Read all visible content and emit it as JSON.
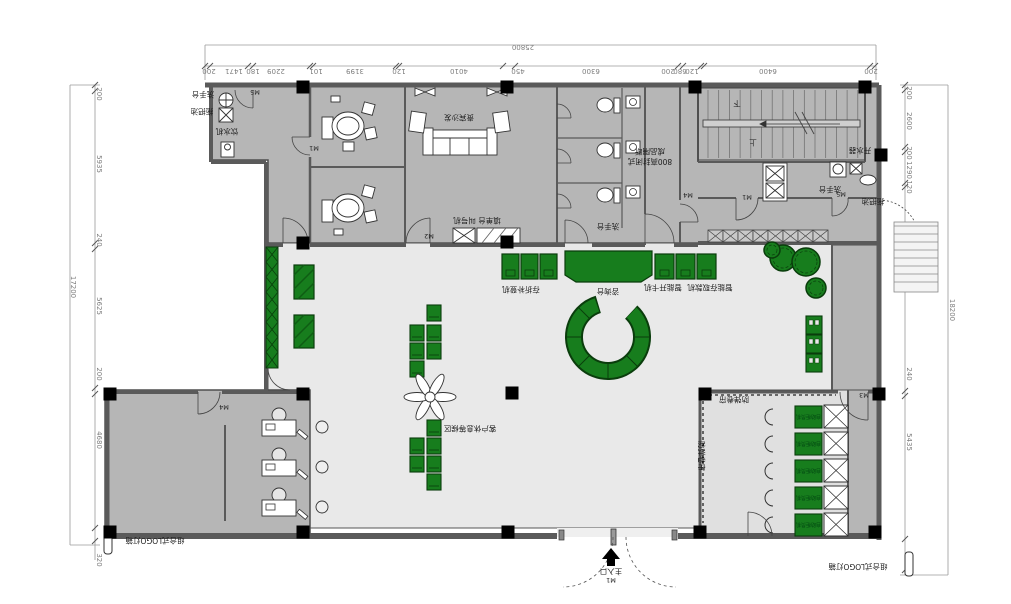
{
  "colors": {
    "wall_fill": "#b6b6b6",
    "wall_line": "#4f4f4f",
    "floor": "#e9e9e9",
    "floor2": "#e0e0e0",
    "green": "#177d1d",
    "green_dark": "#0a3d0c",
    "column": "#000000",
    "dim": "#7d7d7d"
  },
  "labels": {
    "wash_basin_tl": "洗手台",
    "mop_pool_tl": "拖把池",
    "water_dispenser": "饮水机",
    "sofa_room": "贵宾沙发",
    "form_desk": "填单台 叫号机",
    "wc_partition_line1": "800高封闭式",
    "wc_partition_line2": "成品隔断",
    "wc_wash": "洗手台",
    "stair_up": "上",
    "stair_down": "下",
    "boiler": "开水器",
    "kitchen_wash": "洗手台",
    "kitchen_mop": "拖把池",
    "passbook_machine": "存折补登机",
    "counter": "咨询台",
    "smart_card_machine": "智能开卡机",
    "smart_cash_machine": "智能存取款机",
    "waiting_area": "客户休息等候区",
    "shutter_top": "防弹卷帘",
    "shutter_left": "防弹卷帘",
    "atm": "自助柜员机",
    "entrance": "主入口",
    "logo_left": "组合式LOGO灯箱",
    "logo_right": "组合式LOGO灯箱"
  },
  "door_tags": [
    {
      "t": "M5",
      "x": 255,
      "y": 96
    },
    {
      "t": "M1",
      "x": 314,
      "y": 152
    },
    {
      "t": "M2",
      "x": 429,
      "y": 240
    },
    {
      "t": "M4",
      "x": 688,
      "y": 199
    },
    {
      "t": "M1",
      "x": 747,
      "y": 201
    },
    {
      "t": "M5",
      "x": 841,
      "y": 198
    },
    {
      "t": "M4",
      "x": 224,
      "y": 411
    },
    {
      "t": "M3",
      "x": 864,
      "y": 399
    },
    {
      "t": "M1",
      "x": 611,
      "y": 584
    }
  ],
  "dims": {
    "top": {
      "total": "25800",
      "total_pos": [
        523,
        49
      ],
      "line_total_y": 45,
      "line_seg_y": 66,
      "x1": 205,
      "x2": 876,
      "segments": [
        {
          "t": "200",
          "x": 209
        },
        {
          "t": "1471",
          "x": 234
        },
        {
          "t": "180",
          "x": 253
        },
        {
          "t": "2209",
          "x": 276
        },
        {
          "t": "101",
          "x": 316
        },
        {
          "t": "3199",
          "x": 355
        },
        {
          "t": "120",
          "x": 399
        },
        {
          "t": "4010",
          "x": 459
        },
        {
          "t": "450",
          "x": 518
        },
        {
          "t": "6300",
          "x": 591
        },
        {
          "t": "200",
          "x": 668
        },
        {
          "t": "680",
          "x": 680
        },
        {
          "t": "120",
          "x": 692
        },
        {
          "t": "6400",
          "x": 768
        },
        {
          "t": "200",
          "x": 871
        }
      ],
      "ticks": [
        205,
        210,
        248,
        253,
        310,
        313,
        396,
        399,
        503,
        515,
        678,
        683,
        701,
        704,
        870,
        875
      ]
    },
    "left": {
      "total": "17200",
      "total_pos": [
        71,
        287
      ],
      "line_total_x": 70,
      "line_seg_x": 95,
      "y1": 85,
      "y2": 560,
      "segments": [
        {
          "t": "200",
          "y": 94
        },
        {
          "t": "5935",
          "y": 164
        },
        {
          "t": "240",
          "y": 240
        },
        {
          "t": "5625",
          "y": 306
        },
        {
          "t": "200",
          "y": 374
        },
        {
          "t": "4680",
          "y": 440
        },
        {
          "t": "320",
          "y": 560
        }
      ],
      "ticks": [
        85,
        91,
        243,
        249,
        388,
        394,
        528,
        541
      ]
    },
    "right": {
      "total": "18200",
      "total_pos": [
        950,
        310
      ],
      "line_total_x": 948,
      "line_seg_x": 905,
      "y1": 85,
      "y2": 575,
      "segments": [
        {
          "t": "200",
          "y": 93
        },
        {
          "t": "2600",
          "y": 121
        },
        {
          "t": "200",
          "y": 153
        },
        {
          "t": "1290",
          "y": 170
        },
        {
          "t": "120",
          "y": 187
        },
        {
          "t": "7675",
          "y": 281
        },
        {
          "t": "240",
          "y": 374
        },
        {
          "t": "5435",
          "y": 442
        },
        {
          "t": "440",
          "y": 565
        }
      ],
      "ticks": [
        85,
        90,
        147,
        152,
        183,
        187,
        391,
        396,
        539,
        570
      ]
    }
  },
  "plan": {
    "columns": [
      [
        303,
        87
      ],
      [
        507,
        87
      ],
      [
        695,
        87
      ],
      [
        865,
        87
      ],
      [
        303,
        243
      ],
      [
        507,
        242
      ],
      [
        881,
        155
      ],
      [
        110,
        394
      ],
      [
        303,
        394
      ],
      [
        512,
        393
      ],
      [
        705,
        394
      ],
      [
        879,
        394
      ],
      [
        110,
        532
      ],
      [
        303,
        532
      ],
      [
        508,
        532
      ],
      [
        700,
        532
      ],
      [
        875,
        532
      ]
    ],
    "stair": {
      "x0": 708,
      "step": 10.7,
      "n": 15,
      "y1": 90,
      "y2": 158
    },
    "lattice": {
      "x0": 708,
      "y": 230,
      "w": 15,
      "h": 12,
      "n": 8
    },
    "wc_rows": [
      96,
      141,
      186
    ],
    "atm_rows": [
      405,
      432,
      459,
      486,
      513
    ],
    "waiting_chairs_a": [
      [
        427,
        305
      ],
      [
        410,
        325
      ],
      [
        427,
        325
      ],
      [
        410,
        343
      ],
      [
        427,
        343
      ],
      [
        410,
        361
      ]
    ],
    "waiting_chairs_b": [
      [
        427,
        420
      ],
      [
        410,
        438
      ],
      [
        427,
        438
      ],
      [
        410,
        456
      ],
      [
        427,
        456
      ],
      [
        427,
        474
      ]
    ],
    "desk_rows": [
      414,
      454,
      494
    ],
    "trees": [
      [
        783,
        258,
        13
      ],
      [
        806,
        262,
        14
      ],
      [
        816,
        288,
        10
      ],
      [
        772,
        250,
        8
      ]
    ],
    "right_strip_rows": [
      316,
      335,
      354
    ],
    "counter_left_x": [
      502,
      521,
      540
    ],
    "counter_right_x": [
      655,
      676,
      697
    ],
    "ring": {
      "cx": 608,
      "cy": 337,
      "spokes": [
        0,
        45,
        90,
        135,
        180,
        225
      ]
    },
    "ext_stair": {
      "x1": 894,
      "x2": 938,
      "y0": 226,
      "step": 8,
      "n": 8
    }
  }
}
